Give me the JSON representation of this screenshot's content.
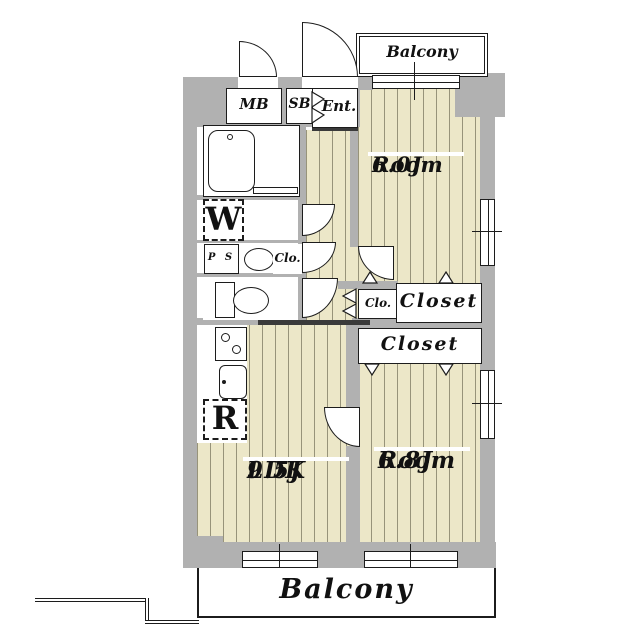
{
  "colors": {
    "wall": "#b1b1b1",
    "floor": "#ece7c8",
    "floor_line": "#97937a",
    "outline": "#1c1c1c"
  },
  "balcony_top": {
    "label": "Balcony"
  },
  "balcony_bottom": {
    "label": "Balcony"
  },
  "entry": {
    "meter_box": "MB",
    "shoe_box": "SB",
    "entrance": "Ent."
  },
  "fixtures": {
    "washer": "W",
    "fridge": "R",
    "pipe_space": "P S"
  },
  "closets": {
    "hall": "Clo.",
    "wash": "Clo.",
    "room1": "Closet",
    "room2": "Closet"
  },
  "rooms": {
    "room1": {
      "name": "Room",
      "size": "6.0J"
    },
    "room2": {
      "name": "Room",
      "size": "6.8J"
    },
    "ldk": {
      "name": "LDK",
      "size": "9.5J"
    }
  }
}
